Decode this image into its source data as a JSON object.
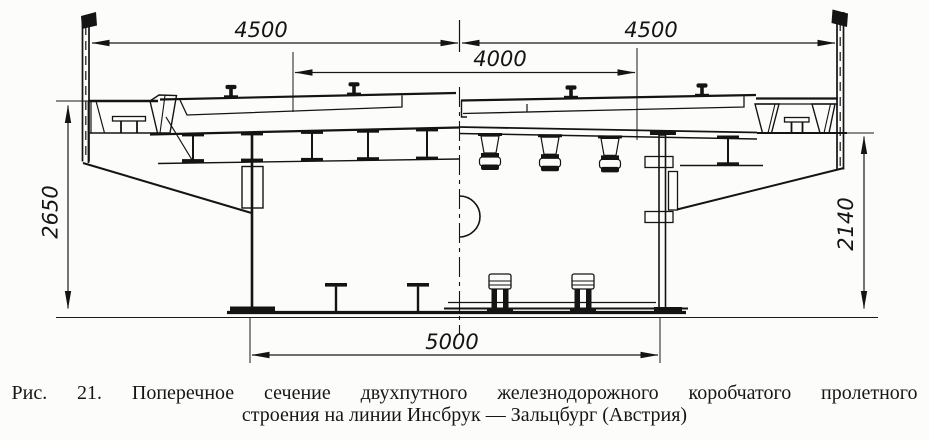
{
  "figure": {
    "caption_lines": [
      "Рис. 21. Поперечное сечение двухпутного железнодорожного коробчатого пролетного",
      "строения на линии Инсбрук — Зальцбург (Австрия)"
    ],
    "dimensions": {
      "top_left": "4500",
      "top_right": "4500",
      "track_spacing": "4000",
      "height_left": "2650",
      "height_right": "2140",
      "bottom_width": "5000"
    }
  }
}
